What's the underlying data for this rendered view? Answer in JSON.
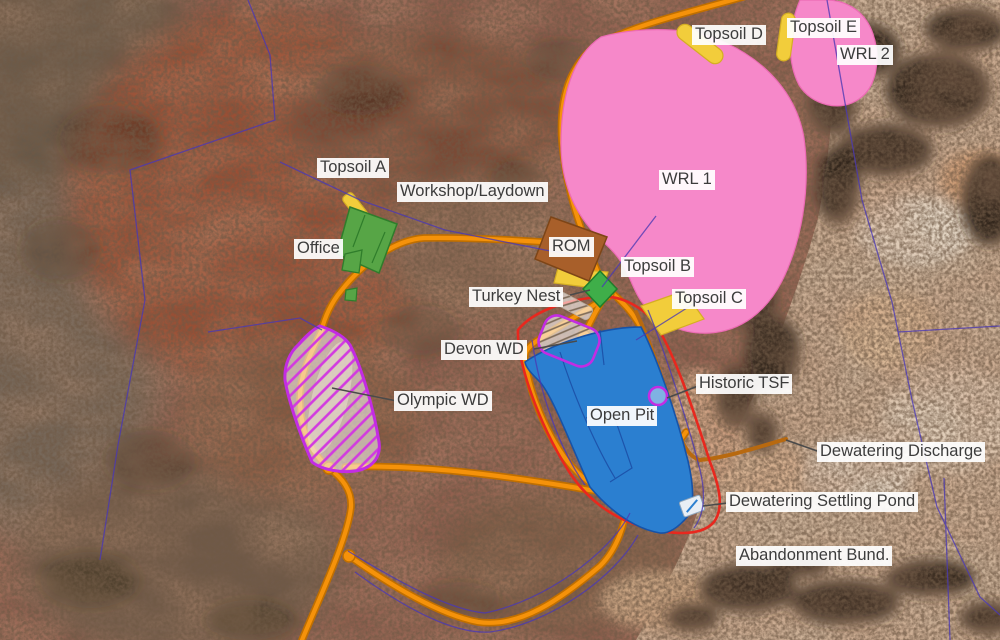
{
  "map_title": "Mine site layout plan over satellite imagery",
  "labels": {
    "topsoil_a": "Topsoil A",
    "topsoil_b": "Topsoil B",
    "topsoil_c": "Topsoil C",
    "topsoil_d": "Topsoil D",
    "topsoil_e": "Topsoil E",
    "wrl_1": "WRL 1",
    "wrl_2": "WRL 2",
    "workshop_laydown": "Workshop/Laydown",
    "office": "Office",
    "rom": "ROM",
    "turkey_nest": "Turkey Nest",
    "devon_wd": "Devon WD",
    "olympic_wd": "Olympic WD",
    "open_pit": "Open Pit",
    "historic_tsf": "Historic TSF",
    "dewatering_discharge": "Dewatering Discharge",
    "dewatering_settling_pond": "Dewatering Settling Pond",
    "abandonment_bund": "Abandonment Bund."
  },
  "features": [
    {
      "id": "wrl-1",
      "label": "WRL 1",
      "kind": "waste-rock-landform",
      "color": "#f688c9"
    },
    {
      "id": "wrl-2",
      "label": "WRL 2",
      "kind": "waste-rock-landform",
      "color": "#f688c9"
    },
    {
      "id": "topsoil-a",
      "label": "Topsoil A",
      "kind": "topsoil-stockpile",
      "color": "#f2cd3b"
    },
    {
      "id": "topsoil-b",
      "label": "Topsoil B",
      "kind": "topsoil-stockpile",
      "color": "#f2cd3b"
    },
    {
      "id": "topsoil-c",
      "label": "Topsoil C",
      "kind": "topsoil-stockpile",
      "color": "#f2cd3b"
    },
    {
      "id": "topsoil-d",
      "label": "Topsoil D",
      "kind": "topsoil-stockpile",
      "color": "#f2cd3b"
    },
    {
      "id": "topsoil-e",
      "label": "Topsoil E",
      "kind": "topsoil-stockpile",
      "color": "#f2cd3b"
    },
    {
      "id": "rom",
      "label": "ROM",
      "kind": "rom-pad",
      "color": "#a85f2a"
    },
    {
      "id": "workshop-laydown",
      "label": "Workshop/Laydown",
      "kind": "facility-area",
      "color": "#57a546"
    },
    {
      "id": "office",
      "label": "Office",
      "kind": "facility-area",
      "color": "#57a546"
    },
    {
      "id": "turkey-nest",
      "label": "Turkey Nest",
      "kind": "water-storage",
      "color": "#3fae49"
    },
    {
      "id": "open-pit",
      "label": "Open Pit",
      "kind": "open-pit",
      "color": "#2b7fd0"
    },
    {
      "id": "devon-wd",
      "label": "Devon WD",
      "kind": "waste-dump-hatched",
      "color": "#c32ce3"
    },
    {
      "id": "olympic-wd",
      "label": "Olympic WD",
      "kind": "waste-dump-hatched",
      "color": "#c32ce3"
    },
    {
      "id": "historic-tsf",
      "label": "Historic TSF",
      "kind": "historic-tailings",
      "color": "#c32ce3"
    },
    {
      "id": "dewatering-discharge",
      "label": "Dewatering Discharge",
      "kind": "pipeline",
      "color": "#b8690f"
    },
    {
      "id": "dewatering-settling-pond",
      "label": "Dewatering Settling Pond",
      "kind": "pond",
      "color": "#e8eef5"
    },
    {
      "id": "abandonment-bund",
      "label": "Abandonment Bund.",
      "kind": "bund-outline",
      "color": "#e8281e"
    }
  ],
  "colors": {
    "waste_rock_pink": "#f688c9",
    "topsoil_yellow": "#f2cd3b",
    "rom_brown": "#a85f2a",
    "facility_green": "#57a546",
    "pit_blue": "#2b7fd0",
    "road_orange": "#f5920a",
    "disturbance_magenta": "#c32ce3",
    "bund_red": "#e8281e",
    "cadastral_indigo": "#4a39b4",
    "pipeline_dark_orange": "#b8690f"
  }
}
